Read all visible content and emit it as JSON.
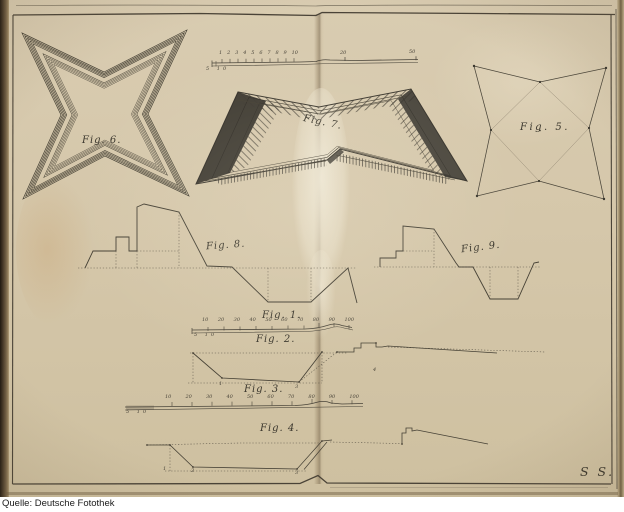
{
  "caption": {
    "source_label": "Quelle: Deutsche Fotothek"
  },
  "plate": {
    "signature": "S S.",
    "figures": {
      "fig1": "Fig. 1.",
      "fig2": "Fig. 2.",
      "fig3": "Fig. 3.",
      "fig4": "Fig. 4.",
      "fig5": "Fig. 5.",
      "fig6": "Fig. 6.",
      "fig7": "Fig. 7.",
      "fig8": "Fig. 8.",
      "fig9": "Fig. 9."
    },
    "scales": {
      "top_ruler": {
        "units": [
          "1",
          "2",
          "3",
          "4",
          "5",
          "6",
          "7",
          "8",
          "9",
          "10"
        ],
        "mid_mark": "20",
        "end_mark": "50",
        "sub_left": "5 10"
      },
      "fig1": {
        "ticks": [
          "10",
          "20",
          "30",
          "40",
          "50",
          "60",
          "70",
          "80",
          "90",
          "100"
        ],
        "sub_left": "5 10"
      },
      "fig3": {
        "ticks": [
          "10",
          "20",
          "30",
          "40",
          "50",
          "60",
          "70",
          "80",
          "90",
          "100"
        ],
        "sub_left": "5 10"
      }
    },
    "point_marks": {
      "fig2": [
        "1",
        "3",
        "4"
      ],
      "fig4": [
        "1",
        "2",
        "3"
      ]
    },
    "colors": {
      "paper": "#d5c7aa",
      "ink": "#3e3a30",
      "binding": "#2f2619",
      "caption_bg": "#ffffff",
      "caption_text": "#1b1b1b"
    }
  }
}
